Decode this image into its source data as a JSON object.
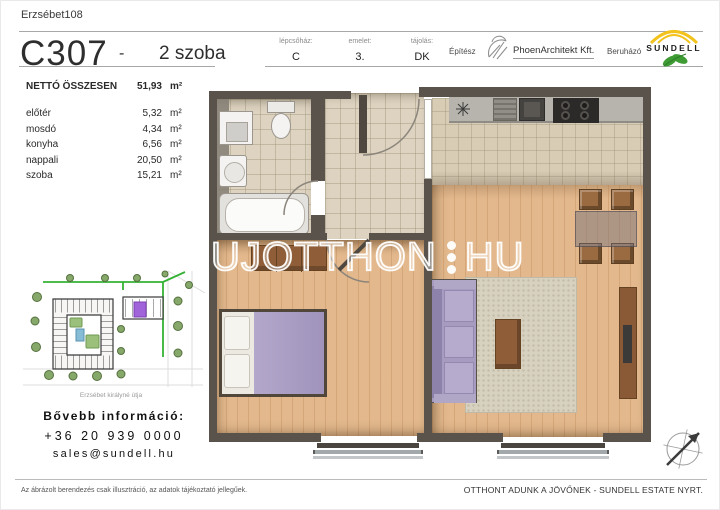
{
  "header": {
    "project_name": "Erzsébet108",
    "unit_code": "C307",
    "separator": "-",
    "room_count": "2 szoba",
    "info_columns": [
      {
        "label": "lépcsőház:",
        "value": "C"
      },
      {
        "label": "emelet:",
        "value": "3."
      },
      {
        "label": "tájolás:",
        "value": "DK"
      }
    ],
    "architect_label": "Építész",
    "architect_name": "PhoenArchitekt Kft.",
    "developer_label": "Beruházó",
    "developer_name": "SUNDELL"
  },
  "area_table": {
    "total_label": "NETTÓ ÖSSZESEN",
    "total_value": "51,93",
    "total_unit": "m²",
    "rows": [
      {
        "name": "előtér",
        "value": "5,32",
        "unit": "m²"
      },
      {
        "name": "mosdó",
        "value": "4,34",
        "unit": "m²"
      },
      {
        "name": "konyha",
        "value": "6,56",
        "unit": "m²"
      },
      {
        "name": "nappali",
        "value": "20,50",
        "unit": "m²"
      },
      {
        "name": "szoba",
        "value": "15,21",
        "unit": "m²"
      }
    ]
  },
  "site_plan": {
    "street_caption": "Erzsébet királyné útja",
    "highlighted_unit_color": "#a163d9",
    "boundary_color": "#35b234"
  },
  "contact": {
    "heading": "Bővebb információ:",
    "phone": "+36 20 939 0000",
    "email": "sales@sundell.hu"
  },
  "watermark": {
    "text_left": "UJOTTHON",
    "text_right": "HU"
  },
  "footer": {
    "disclaimer": "Az ábrázolt berendezés csak illusztráció, az adatok tájékoztató jellegűek.",
    "slogan": "OTTHONT ADUNK A JÖVŐNEK - SUNDELL ESTATE NYRT."
  },
  "colors": {
    "wall": "#59534b",
    "tile_floor": "#ddd3c0",
    "wood_floor": "#e2b88c",
    "purple_furniture": "#a89dc2",
    "brand_yellow": "#f2c21d",
    "brand_green": "#3f9c35"
  }
}
